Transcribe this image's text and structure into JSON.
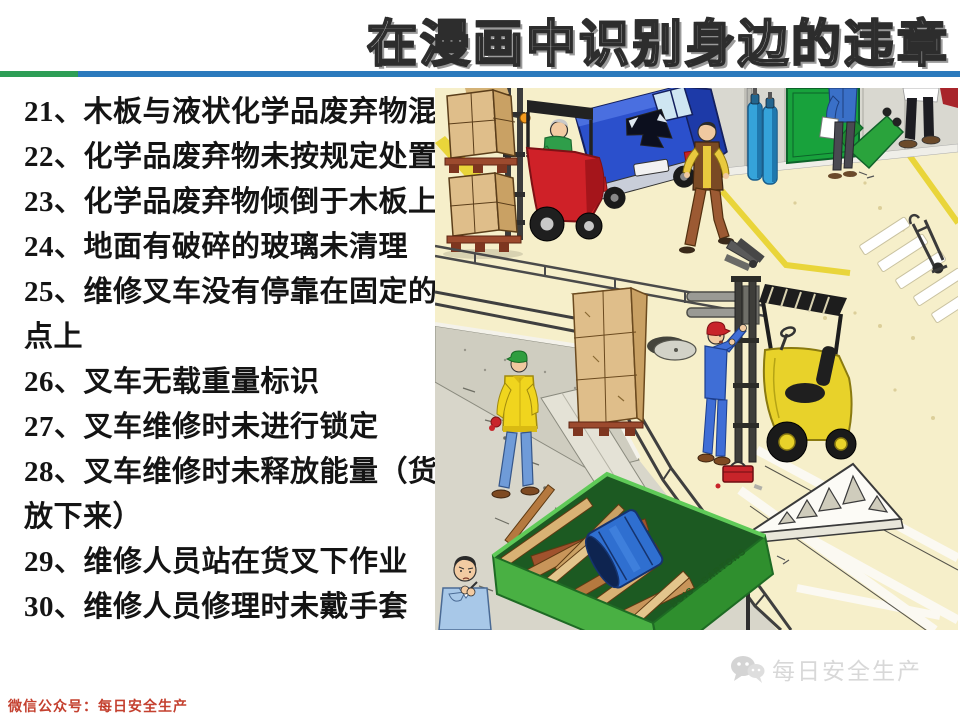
{
  "title": "在漫画中识别身边的违章",
  "divider": {
    "green": "#2e9e56",
    "blue": "#2b7abd"
  },
  "violations": {
    "lines": [
      "21、木板与液状化学品废弃物混放",
      "22、化学品废弃物未按规定处置",
      "23、化学品废弃物倾倒于木板上",
      "24、地面有破碎的玻璃未清理",
      "25、维修叉车没有停靠在固定的停车",
      "点上",
      "26、叉车无载重量标识",
      "27、叉车维修时未进行锁定",
      "28、叉车维修时未释放能量（货叉应",
      "放下来）",
      "29、维修人员站在货叉下作业",
      "30、维修人员修理时未戴手套"
    ]
  },
  "illustration": {
    "dumpster_label": "BOIS - CARTONS",
    "colors": {
      "floor": "#f6efca",
      "wall_gray": "#d9d8d0",
      "door_green": "#18a23c",
      "dumpster_green": "#49b043",
      "forklift_red": "#cf2128",
      "forklift_yellow": "#e8d22a",
      "van_blue": "#2b50cc",
      "drum_blue": "#2f6fd0",
      "lane_yellow": "#e9d53a"
    }
  },
  "footer": {
    "wechat_label": "微信公众号：每日安全生产"
  },
  "watermark": {
    "text": "每日安全生产"
  }
}
